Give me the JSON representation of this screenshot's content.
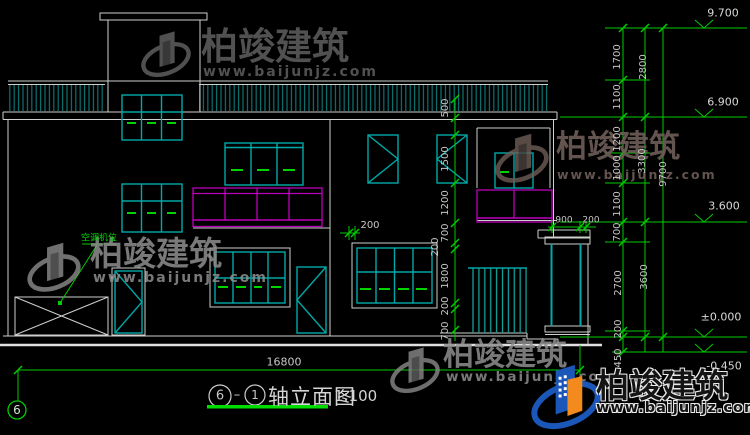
{
  "title": {
    "bubble_left": "6",
    "separator": "–",
    "bubble_right": "1",
    "text": "轴立面图",
    "scale": "1:100"
  },
  "axis": {
    "bubble": "6"
  },
  "annotations": {
    "ac_unit": "空调机位"
  },
  "dimensions": {
    "bottom_total": "16800",
    "right_total": "9700",
    "right_mid": [
      "2800",
      "3300",
      "3600"
    ],
    "right_inner": [
      "1700",
      "1100",
      "1200",
      "1000",
      "1100",
      "700",
      "2700",
      "200",
      "450"
    ],
    "mid_chain": [
      "500",
      "1500",
      "1200",
      "700",
      "200",
      "1800",
      "200",
      "700"
    ],
    "balcony_offset": "200",
    "porch_a": "900",
    "porch_b": "200"
  },
  "elevations": [
    "9.700",
    "6.900",
    "3.600",
    "±0.000",
    "-0.450"
  ],
  "watermark": {
    "brand": "柏竣建筑",
    "url": "www.baijunjz.com"
  },
  "colors": {
    "wall_line": "#cdd0cd",
    "window_teal": "#00a8a8",
    "dim_green": "#00cc00",
    "railing_magenta": "#bb00bb",
    "logo_blue": "#1a57b8",
    "logo_orange": "#f28a1d"
  }
}
